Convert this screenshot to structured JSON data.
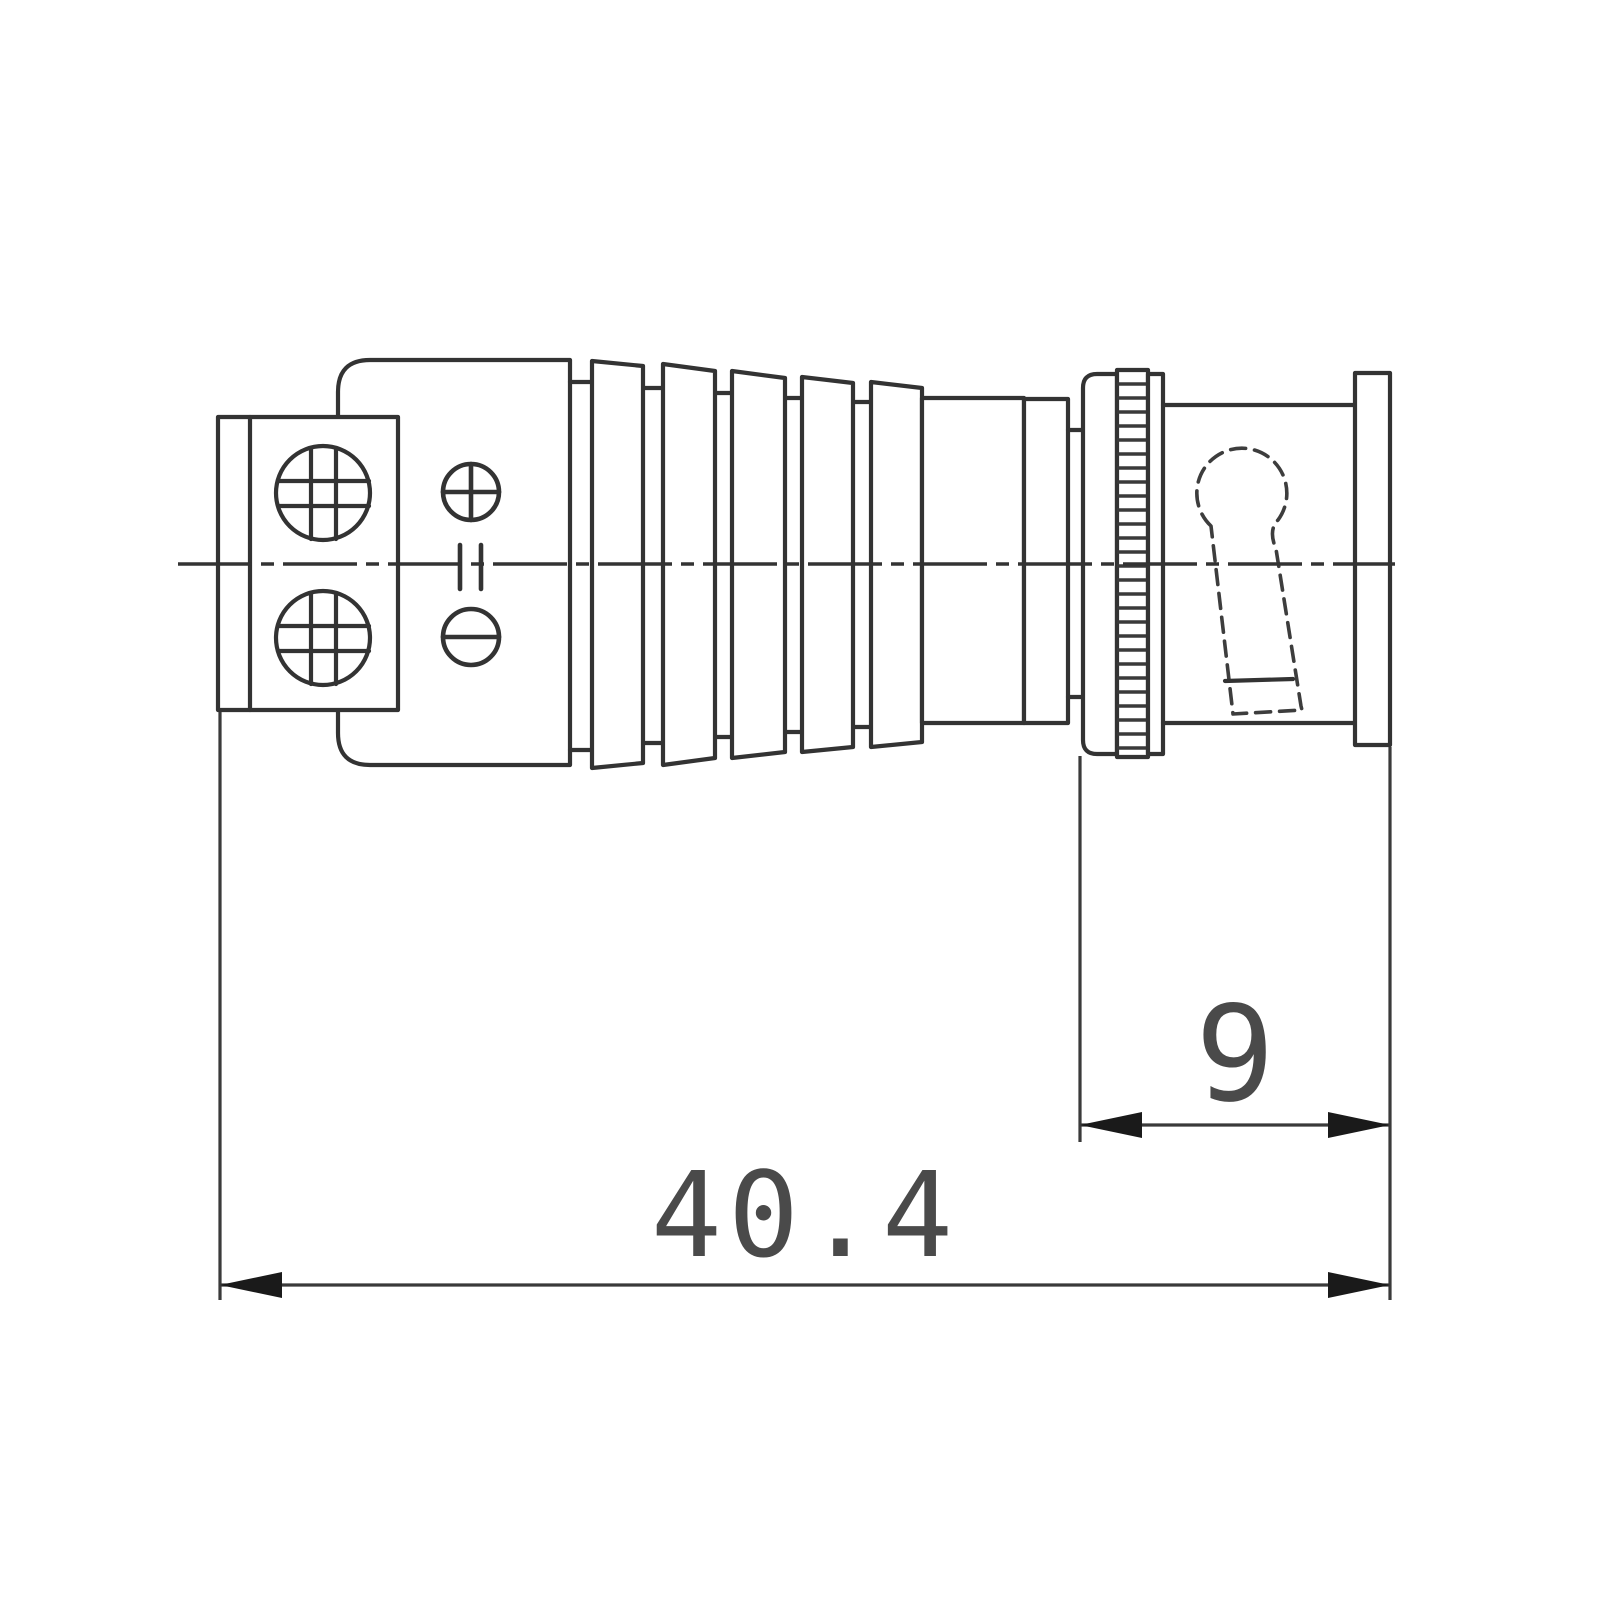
{
  "figure": {
    "type": "technical-drawing",
    "view": "side-profile-with-dimensions"
  },
  "colors": {
    "background": "#ffffff",
    "line": "#333333",
    "dimension_text": "#4a4a4a",
    "arrow_fill": "#1a1a1a"
  },
  "dimensions": [
    {
      "name": "coupling-length",
      "label": "9"
    },
    {
      "name": "overall-length",
      "label": "40.4"
    }
  ],
  "icons": {
    "phillips_screw": "cross-in-circle",
    "positive_terminal": "plus-in-circle",
    "negative_terminal": "minus-in-circle",
    "dc_marker": "double-bar"
  }
}
